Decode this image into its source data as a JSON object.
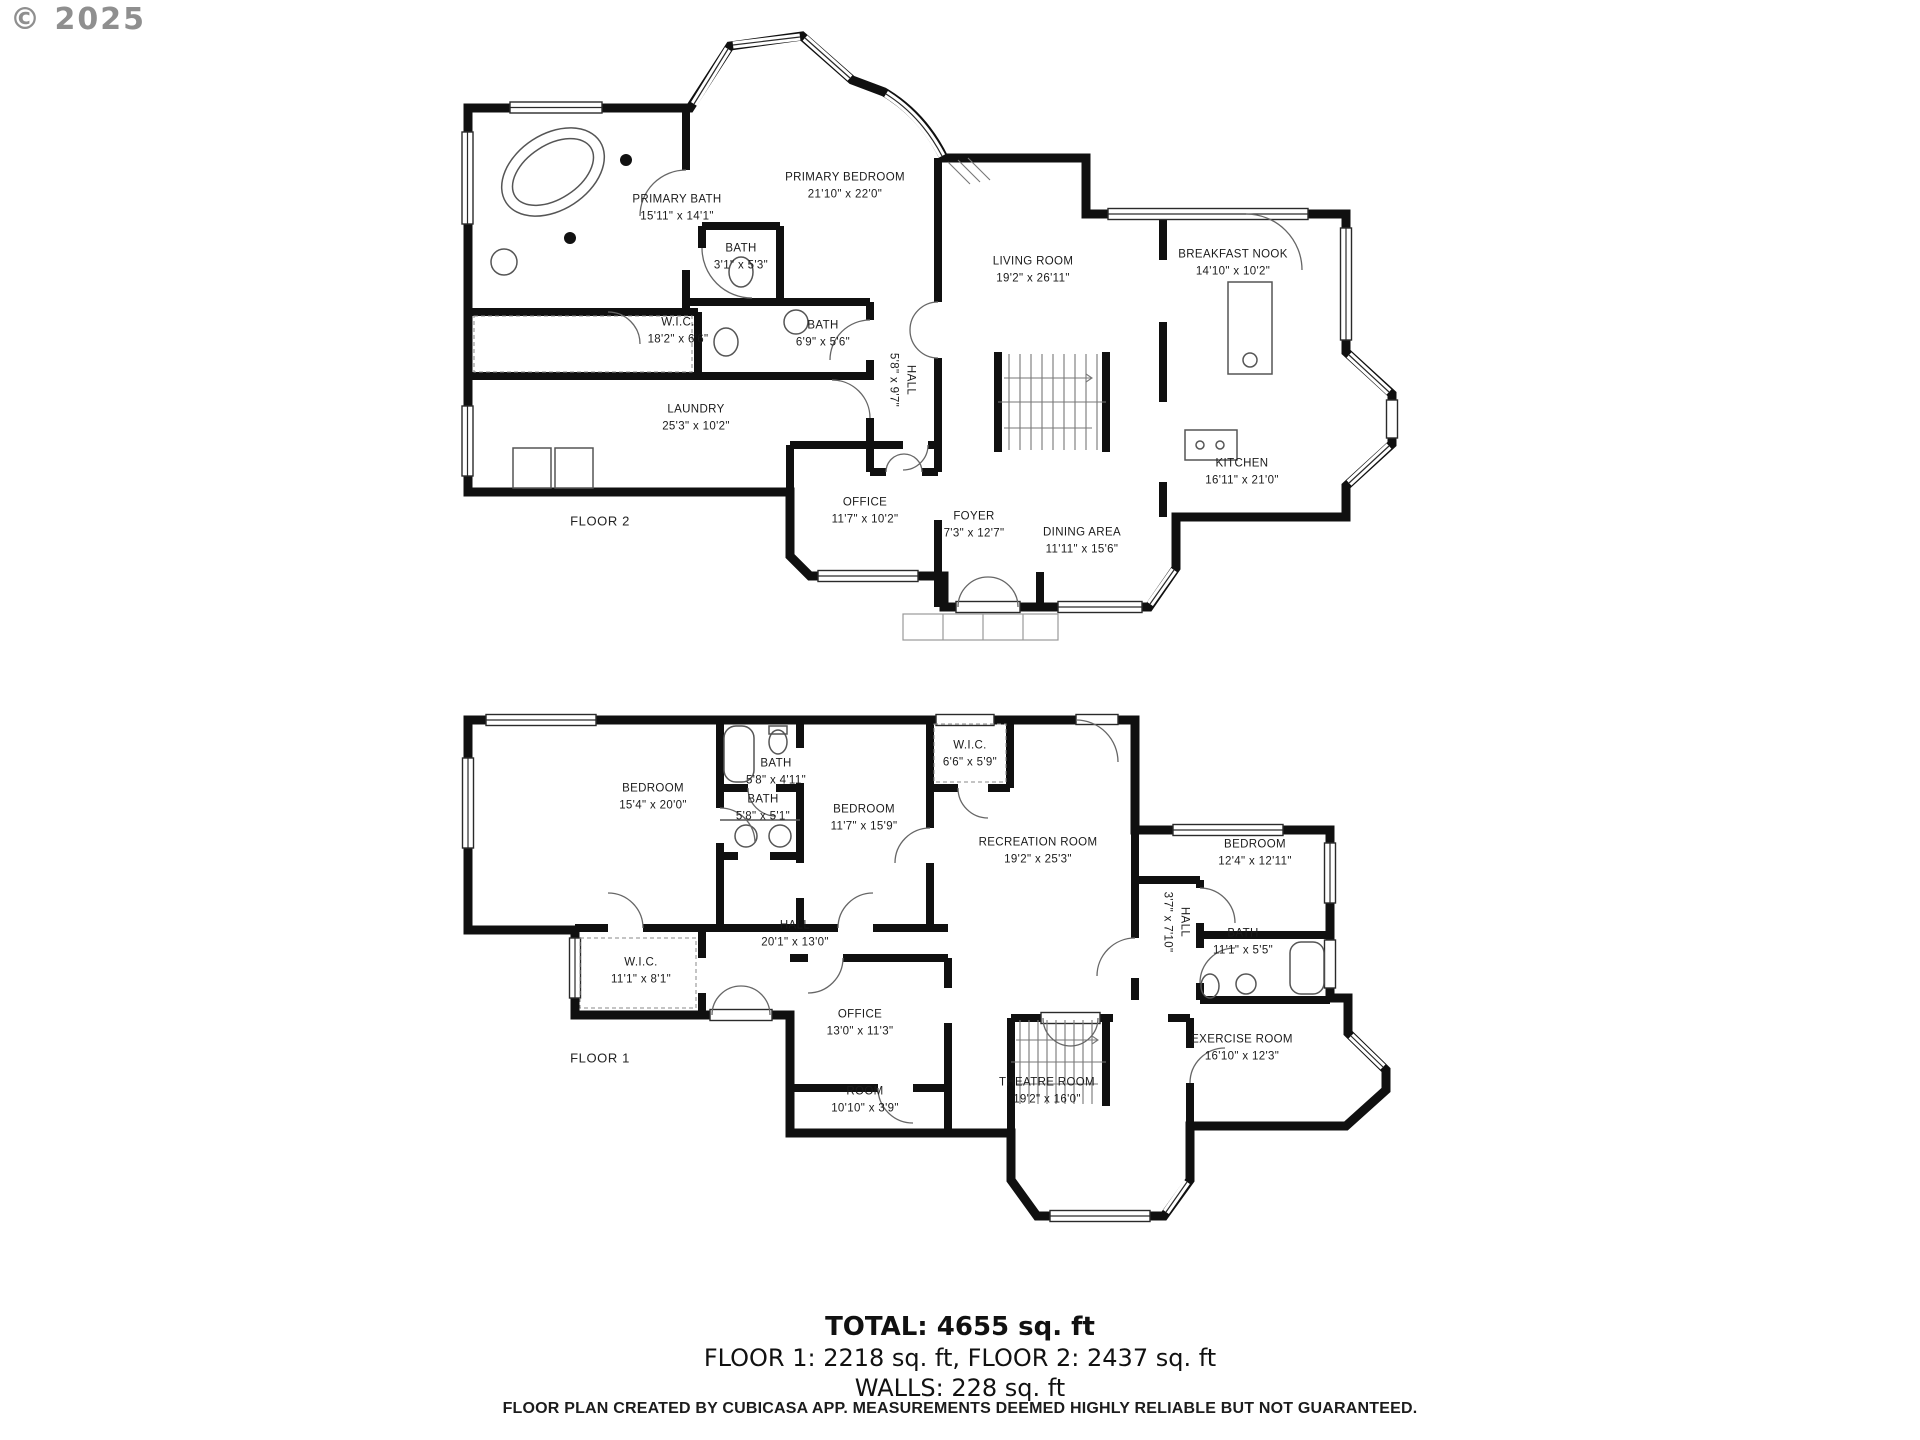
{
  "copyright": "© 2025",
  "floor2": {
    "floor_label": "FLOOR 2",
    "rooms": [
      {
        "name": "PRIMARY BATH",
        "dims": "15'11\" x 14'1\""
      },
      {
        "name": "PRIMARY BEDROOM",
        "dims": "21'10\" x 22'0\""
      },
      {
        "name": "BATH",
        "dims": "3'1\" x 5'3\""
      },
      {
        "name": "W.I.C.",
        "dims": "18'2\" x 6'6\""
      },
      {
        "name": "BATH",
        "dims": "6'9\" x 5'6\""
      },
      {
        "name": "HALL",
        "dims": "5'8\" x 9'7\""
      },
      {
        "name": "LIVING ROOM",
        "dims": "19'2\" x 26'11\""
      },
      {
        "name": "BREAKFAST NOOK",
        "dims": "14'10\" x 10'2\""
      },
      {
        "name": "LAUNDRY",
        "dims": "25'3\" x 10'2\""
      },
      {
        "name": "KITCHEN",
        "dims": "16'11\" x 21'0\""
      },
      {
        "name": "OFFICE",
        "dims": "11'7\" x 10'2\""
      },
      {
        "name": "FOYER",
        "dims": "7'3\" x 12'7\""
      },
      {
        "name": "DINING AREA",
        "dims": "11'11\" x 15'6\""
      }
    ]
  },
  "floor1": {
    "floor_label": "FLOOR 1",
    "rooms": [
      {
        "name": "BEDROOM",
        "dims": "15'4\" x 20'0\""
      },
      {
        "name": "BATH",
        "dims": "5'8\" x 4'11\""
      },
      {
        "name": "BATH",
        "dims": "5'8\" x 5'1\""
      },
      {
        "name": "BEDROOM",
        "dims": "11'7\" x 15'9\""
      },
      {
        "name": "W.I.C.",
        "dims": "6'6\" x 5'9\""
      },
      {
        "name": "RECREATION ROOM",
        "dims": "19'2\" x 25'3\""
      },
      {
        "name": "BEDROOM",
        "dims": "12'4\" x 12'11\""
      },
      {
        "name": "HALL",
        "dims": "20'1\" x 13'0\""
      },
      {
        "name": "W.I.C.",
        "dims": "11'1\" x 8'1\""
      },
      {
        "name": "HALL",
        "dims": "3'7\" x 7'10\""
      },
      {
        "name": "BATH",
        "dims": "11'1\" x 5'5\""
      },
      {
        "name": "OFFICE",
        "dims": "13'0\" x 11'3\""
      },
      {
        "name": "EXERCISE ROOM",
        "dims": "16'10\" x 12'3\""
      },
      {
        "name": "ROOM",
        "dims": "10'10\" x 3'9\""
      },
      {
        "name": "THEATRE ROOM",
        "dims": "19'2\" x 16'0\""
      }
    ]
  },
  "summary": {
    "total": "TOTAL: 4655 sq. ft",
    "floors": "FLOOR 1: 2218 sq. ft, FLOOR 2: 2437 sq. ft",
    "walls": "WALLS: 228 sq. ft"
  },
  "footer": "FLOOR PLAN CREATED BY CUBICASA APP. MEASUREMENTS DEEMED HIGHLY RELIABLE BUT NOT GUARANTEED."
}
